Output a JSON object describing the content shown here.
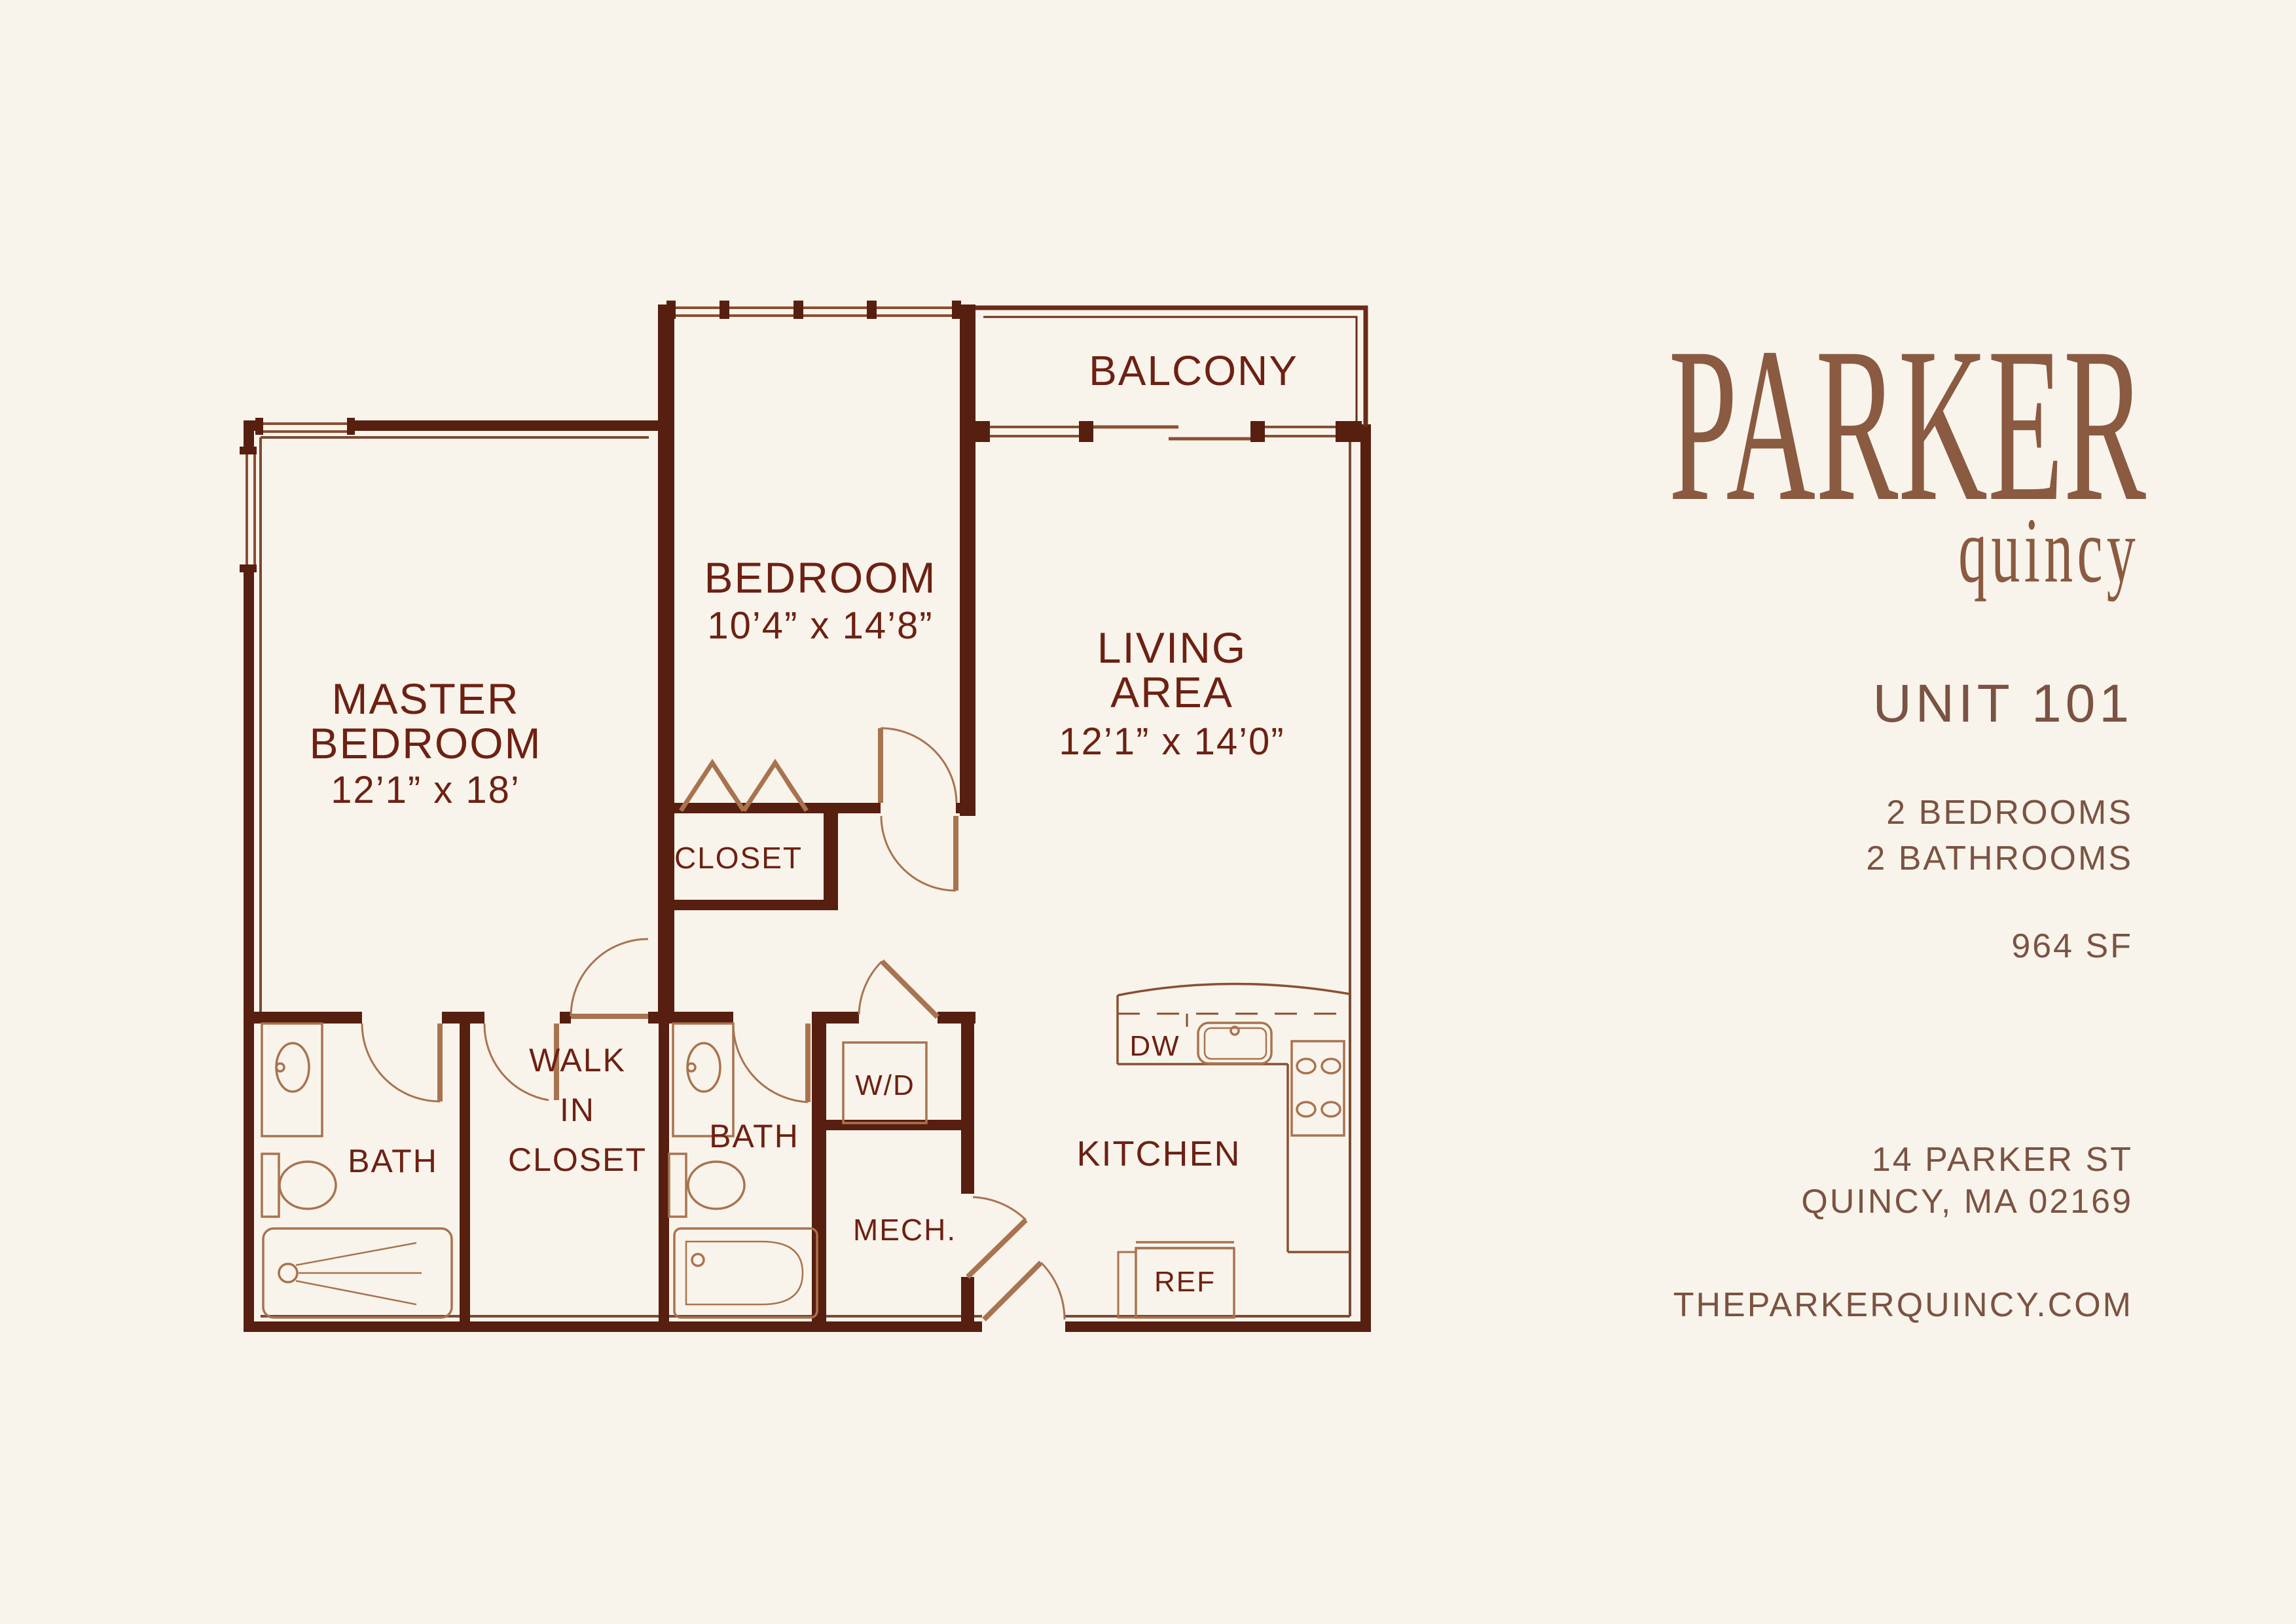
{
  "brand": {
    "name": "PARKER",
    "sub": "quincy"
  },
  "unit": {
    "title": "UNIT 101",
    "bedrooms": "2 BEDROOMS",
    "bathrooms": "2 BATHROOMS",
    "area": "964 SF"
  },
  "address": {
    "line1": "14 PARKER ST",
    "line2": "QUINCY, MA 02169",
    "website": "THEPARKERQUINCY.COM"
  },
  "plan_labels": {
    "master": {
      "l1": "MASTER",
      "l2": "BEDROOM",
      "dims": "12’1” x 18’"
    },
    "bedroom": {
      "l1": "BEDROOM",
      "dims": "10’4” x 14’8”"
    },
    "living": {
      "l1": "LIVING",
      "l2": "AREA",
      "dims": "12’1” x 14’0”"
    },
    "balcony": "BALCONY",
    "closet": "CLOSET",
    "bath1": "BATH",
    "bath2": "BATH",
    "wic": {
      "l1": "WALK",
      "l2": "IN",
      "l3": "CLOSET"
    },
    "wd": "W/D",
    "mech": "MECH.",
    "kitchen": "KITCHEN",
    "dw": "DW",
    "ref": "REF"
  },
  "colors": {
    "background": "#f8f4eb",
    "wall": "#571f10",
    "plan_text": "#6d2113",
    "fixture_line": "#a9734f",
    "brand_brown": "#8a5a41",
    "info_text": "#7b5342"
  }
}
